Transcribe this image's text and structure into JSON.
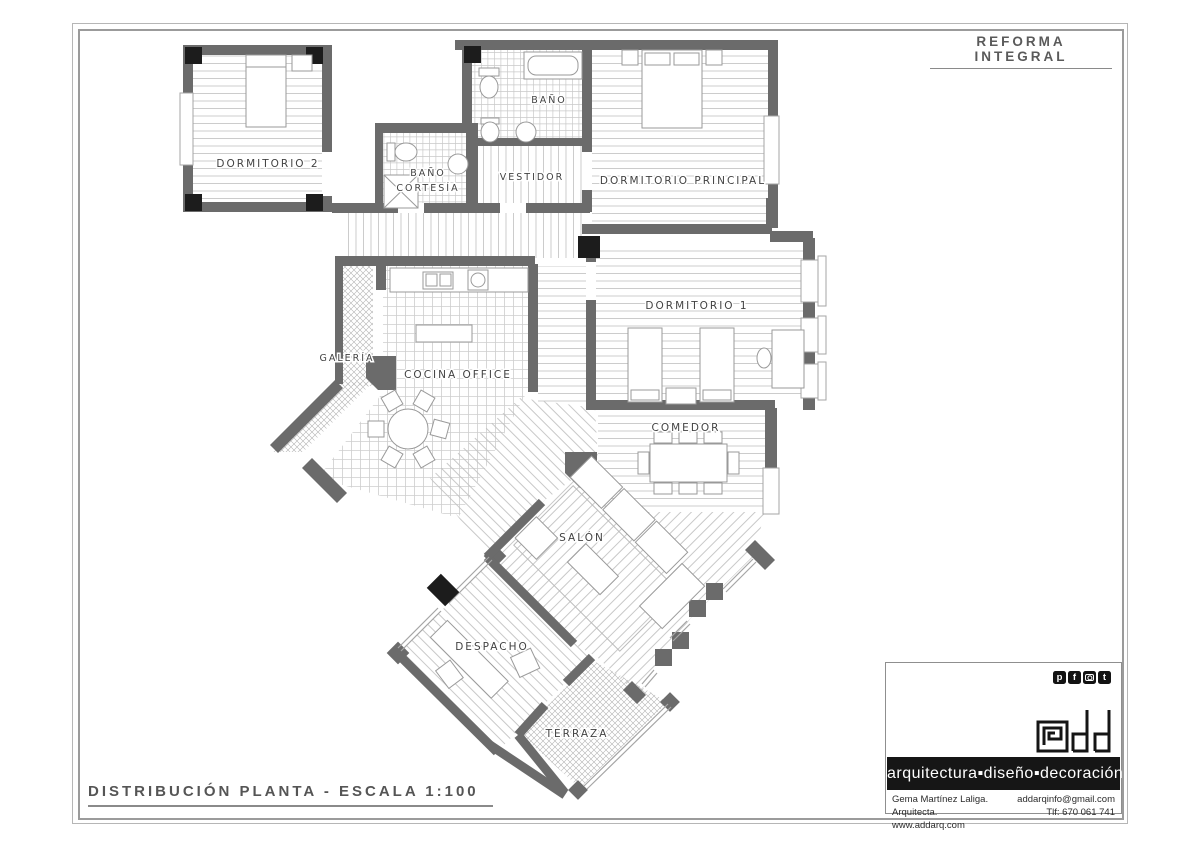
{
  "frame": {
    "title": "REFORMA INTEGRAL",
    "caption": "DISTRIBUCIÓN PLANTA - ESCALA 1:100"
  },
  "plan": {
    "rooms": {
      "dormitorio2": "DORMITORIO 2",
      "bano_cortesia_1": "BAÑO",
      "bano_cortesia_2": "CORTESÍA",
      "bano": "BAÑO",
      "vestidor": "VESTIDOR",
      "dormitorio_principal": "DORMITORIO PRINCIPAL",
      "dormitorio1": "DORMITORIO 1",
      "galeria": "GALERÍA",
      "cocina": "COCINA OFFICE",
      "comedor": "COMEDOR",
      "salon": "SALÓN",
      "despacho": "DESPACHO",
      "terraza": "TERRAZA"
    }
  },
  "brand": {
    "social": [
      {
        "icon": "pinterest-icon",
        "glyph": "p"
      },
      {
        "icon": "facebook-icon",
        "glyph": "f"
      },
      {
        "icon": "instagram-icon",
        "glyph": ""
      },
      {
        "icon": "twitter-icon",
        "glyph": "t"
      }
    ],
    "logo": "@dd",
    "tagline": "arquitectura▪diseño▪decoración",
    "architect": "Gema Martínez Laliga. Arquitecta.",
    "website": "www.addarq.com",
    "email": "addarqinfo@gmail.com",
    "phone": "Tlf: 670 061 741"
  },
  "colors": {
    "wall": "#6b6b6b",
    "column": "#1c1c1c",
    "floor_line": "#c6c6c6",
    "label_text": "#424242",
    "frame_line": "#9b9b9b",
    "brand_black": "#161616"
  }
}
